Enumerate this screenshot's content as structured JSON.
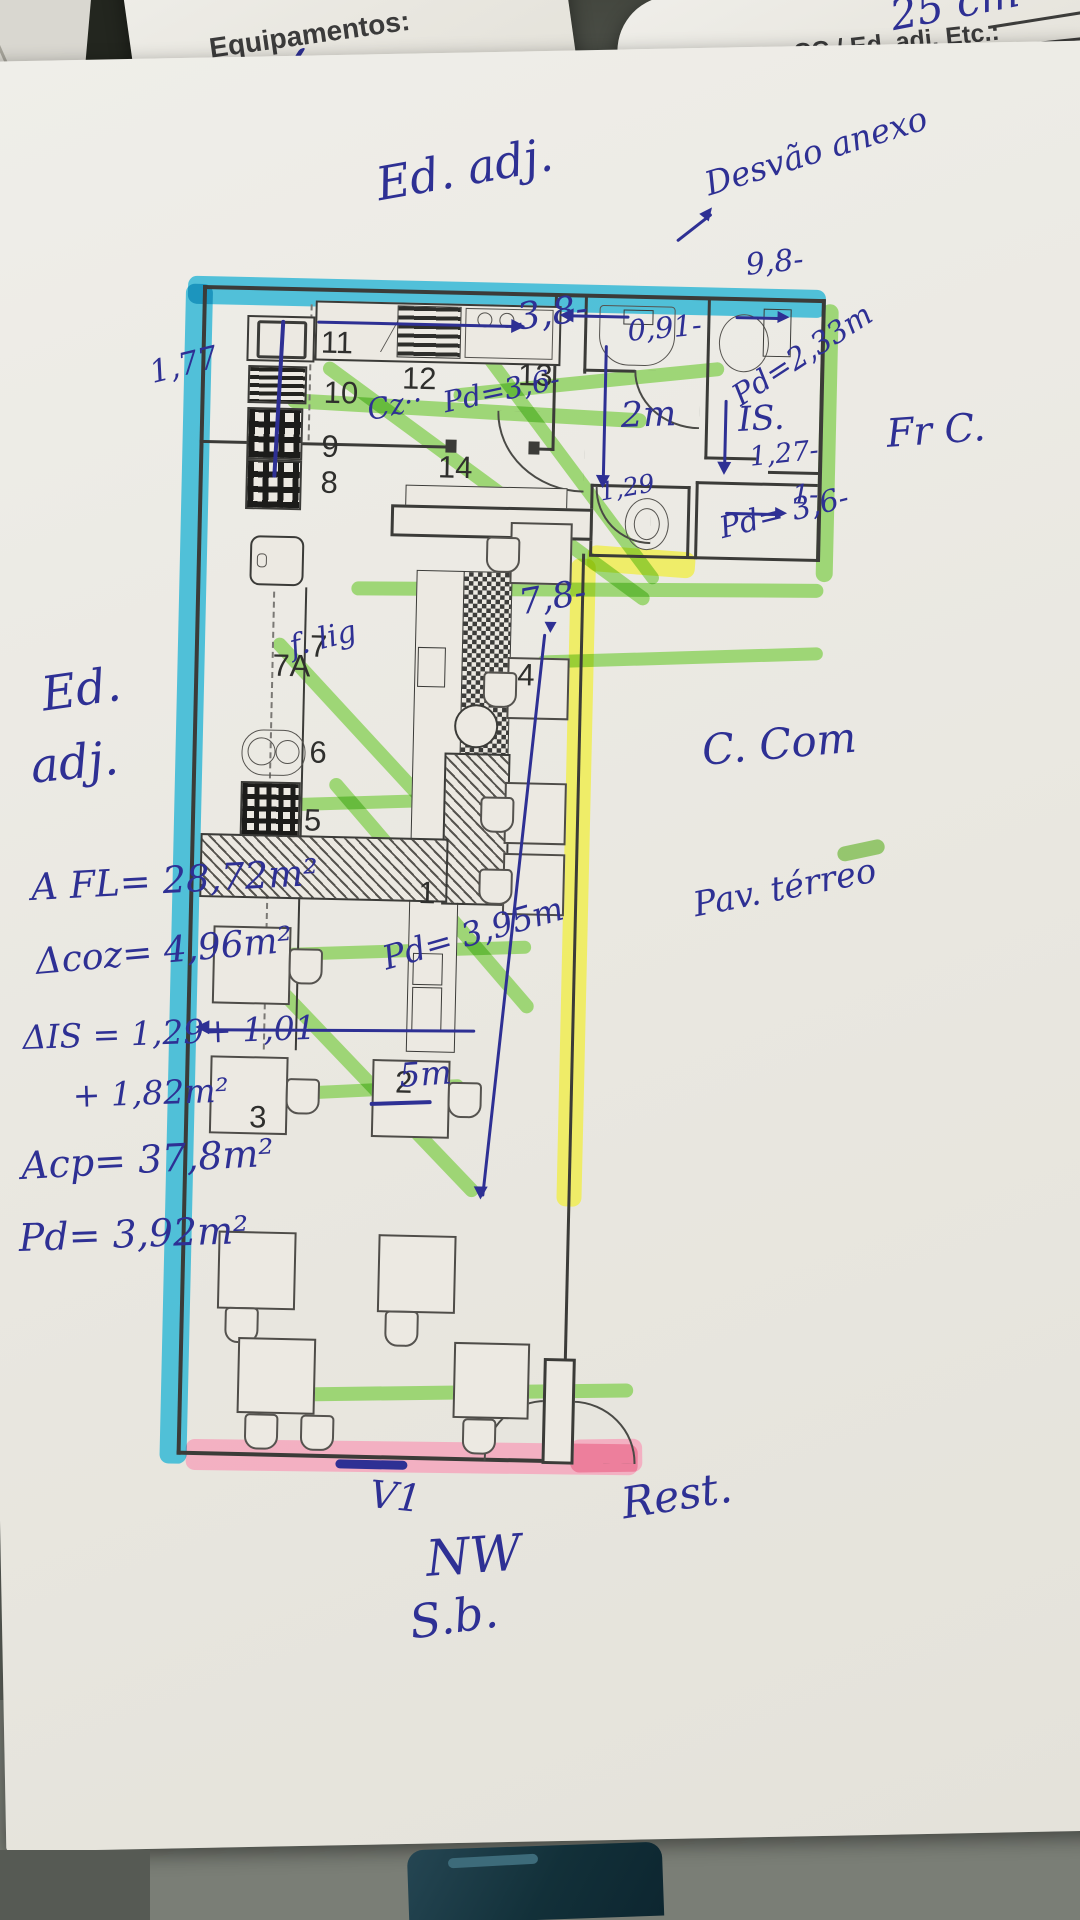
{
  "background_form": {
    "ruler_note": "25 cm",
    "equip_header": "Equipamentos:",
    "equip_item1": "Elevador",
    "equip_check": "✓",
    "equip_item2": "Rede de G",
    "right_header": "nteriores CC / Ed. adj. Etc.:",
    "ra_label": "ra:",
    "ra_value": "15cm"
  },
  "plan_labels": {
    "n1": "1",
    "n2": "2",
    "n3": "3",
    "n4": "4",
    "n5": "5",
    "n6": "6",
    "n7": "7",
    "n7a": "7A",
    "n8": "8",
    "n9": "9",
    "n10": "10",
    "n11": "11",
    "n12": "12",
    "n13": "13",
    "n14": "14"
  },
  "annotations": {
    "ed_adj_top": "Ed. adj.",
    "desvao": "Desvão anexo",
    "dim_98": "9,8-",
    "dim_38": "3,8-",
    "dim_091": "0,91-",
    "pd_233": "Pd=2,33m",
    "is_room": "IS.",
    "dim_127": "1,27-",
    "dim_2m": "2m",
    "dim_1": "1-",
    "pd_36_right": "Pd= 3,6-",
    "dim_129": "1,29",
    "fr_c": "Fr C.",
    "dim_177": "1,77",
    "cz": "Cz··",
    "pd_36_kitchen": "Pd=3,6-",
    "dim_78": "7,8-",
    "f_lig": "f. lig",
    "c_com": "C. Com",
    "pav_terreo": "Pav. térreo",
    "pd_395": "Pd= 3,95m",
    "dim_5m": "5m",
    "ed_left_1": "Ed.",
    "ed_left_2": "adj.",
    "area_fl": "A FL= 28,72m²",
    "area_coz": "Δcoz= 4,96m²",
    "area_is_1": "ΔIS = 1,29+ 1,01",
    "area_is_2": "+ 1,82m²",
    "area_cp": "Acp= 37,8m²",
    "pd_392": "Pd= 3,92m²",
    "v1": "V1",
    "rest": "Rest.",
    "nw": "NW",
    "sb": "S.b."
  },
  "colors": {
    "ink": "#2e3094",
    "highlight_cyan": "#35b9d6",
    "highlight_green": "#84cf52",
    "highlight_yellow": "#f0ee4a",
    "highlight_pink": "#f5a7bd",
    "wall": "#3b3b38",
    "paper": "#eceae4"
  }
}
